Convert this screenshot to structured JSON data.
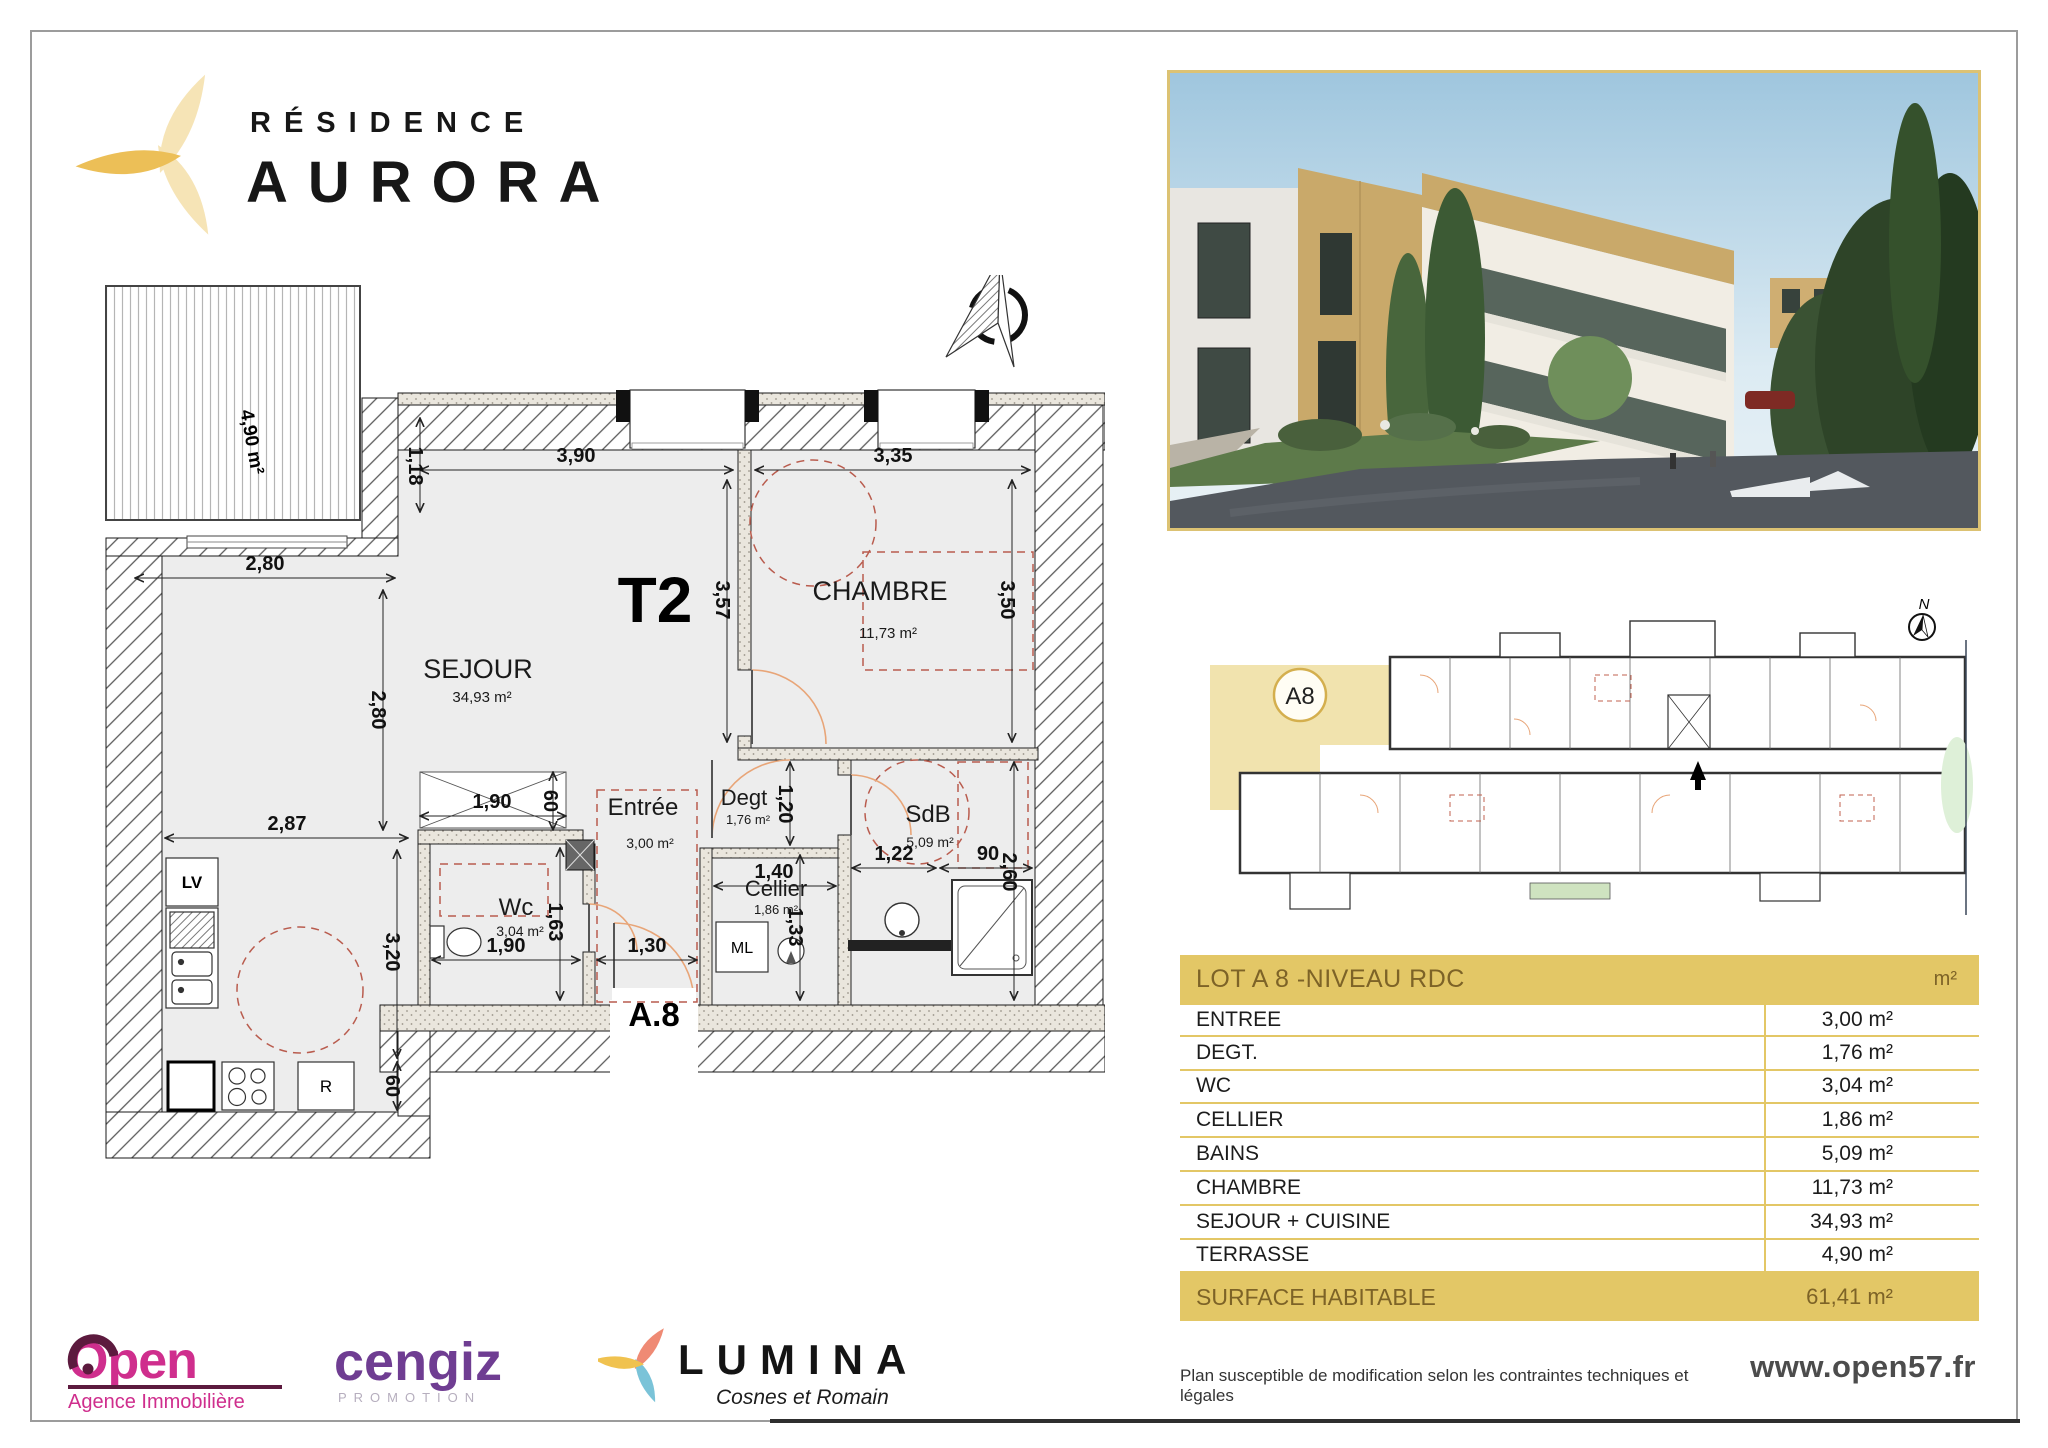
{
  "header": {
    "brand_line1": "RÉSIDENCE",
    "brand_line2": "AURORA"
  },
  "floorplan": {
    "type_label": "T2",
    "lot_label": "A.8",
    "compass_label": "N",
    "terrasse_area": "4,90 m²",
    "rooms": {
      "sejour": {
        "name": "SEJOUR",
        "area": "34,93 m²"
      },
      "chambre": {
        "name": "CHAMBRE",
        "area": "11,73 m²"
      },
      "entree": {
        "name": "Entrée",
        "area": "3,00 m²"
      },
      "degt": {
        "name": "Degt",
        "area": "1,76 m²"
      },
      "sdb": {
        "name": "SdB",
        "area": "5,09 m²"
      },
      "wc": {
        "name": "Wc",
        "area": "3,04 m²"
      },
      "cellier": {
        "name": "Cellier",
        "area": "1,86 m²"
      }
    },
    "appliances": {
      "lv": "LV",
      "r": "R",
      "ml": "ML"
    },
    "dims": {
      "top_sejour": "3,90",
      "top_chambre": "3,35",
      "d118": "1,18",
      "d280h": "2,80",
      "d280v": "2,80",
      "d287": "2,87",
      "d320": "3,20",
      "d60k": "60",
      "d357": "3,57",
      "d350": "3,50",
      "d260": "2,60",
      "d190t": "1,90",
      "d60c": "60",
      "d163": "1,63",
      "d190b": "1,90",
      "d130": "1,30",
      "d140": "1,40",
      "d120": "1,20",
      "d133": "1,33",
      "d122": "1,22",
      "d90": "90"
    }
  },
  "siteplan": {
    "unit_label": "A8",
    "compass_label": "N"
  },
  "table": {
    "header_label": "LOT A 8 -NIVEAU RDC",
    "header_unit": "m²",
    "rows": [
      {
        "label": "ENTREE",
        "value": "3,00 m²"
      },
      {
        "label": "DEGT.",
        "value": "1,76 m²"
      },
      {
        "label": "WC",
        "value": "3,04 m²"
      },
      {
        "label": "CELLIER",
        "value": "1,86 m²"
      },
      {
        "label": "BAINS",
        "value": "5,09 m²"
      },
      {
        "label": "CHAMBRE",
        "value": "11,73 m²"
      },
      {
        "label": "SEJOUR + CUISINE",
        "value": "34,93 m²"
      },
      {
        "label": "TERRASSE",
        "value": "4,90 m²"
      }
    ],
    "footer": {
      "label": "SURFACE HABITABLE",
      "value": "61,41 m²"
    }
  },
  "partners": {
    "open": {
      "name": "Open",
      "tagline": "Agence Immobilière"
    },
    "cengiz": {
      "name": "cengiz",
      "tagline": "PROMOTION"
    },
    "lumina": {
      "name": "LUMINA",
      "tagline": "Cosnes et Romain"
    }
  },
  "footer": {
    "disclaimer": "Plan susceptible de modification selon les contraintes techniques et légales",
    "website": "www.open57.fr"
  },
  "colors": {
    "gold": "#e3c766",
    "gold_text": "#7d6327",
    "highlight": "#f1e3ae",
    "plan_red": "#b95c4e",
    "door_orange": "#e8a578",
    "open_pink": "#cf2e8d",
    "open_maroon": "#5c1a3e",
    "cengiz_purple": "#6f3d92",
    "lumina_salmon": "#ef8a74",
    "lumina_teal": "#7ac3d8",
    "lumina_yellow": "#f0c24f"
  }
}
